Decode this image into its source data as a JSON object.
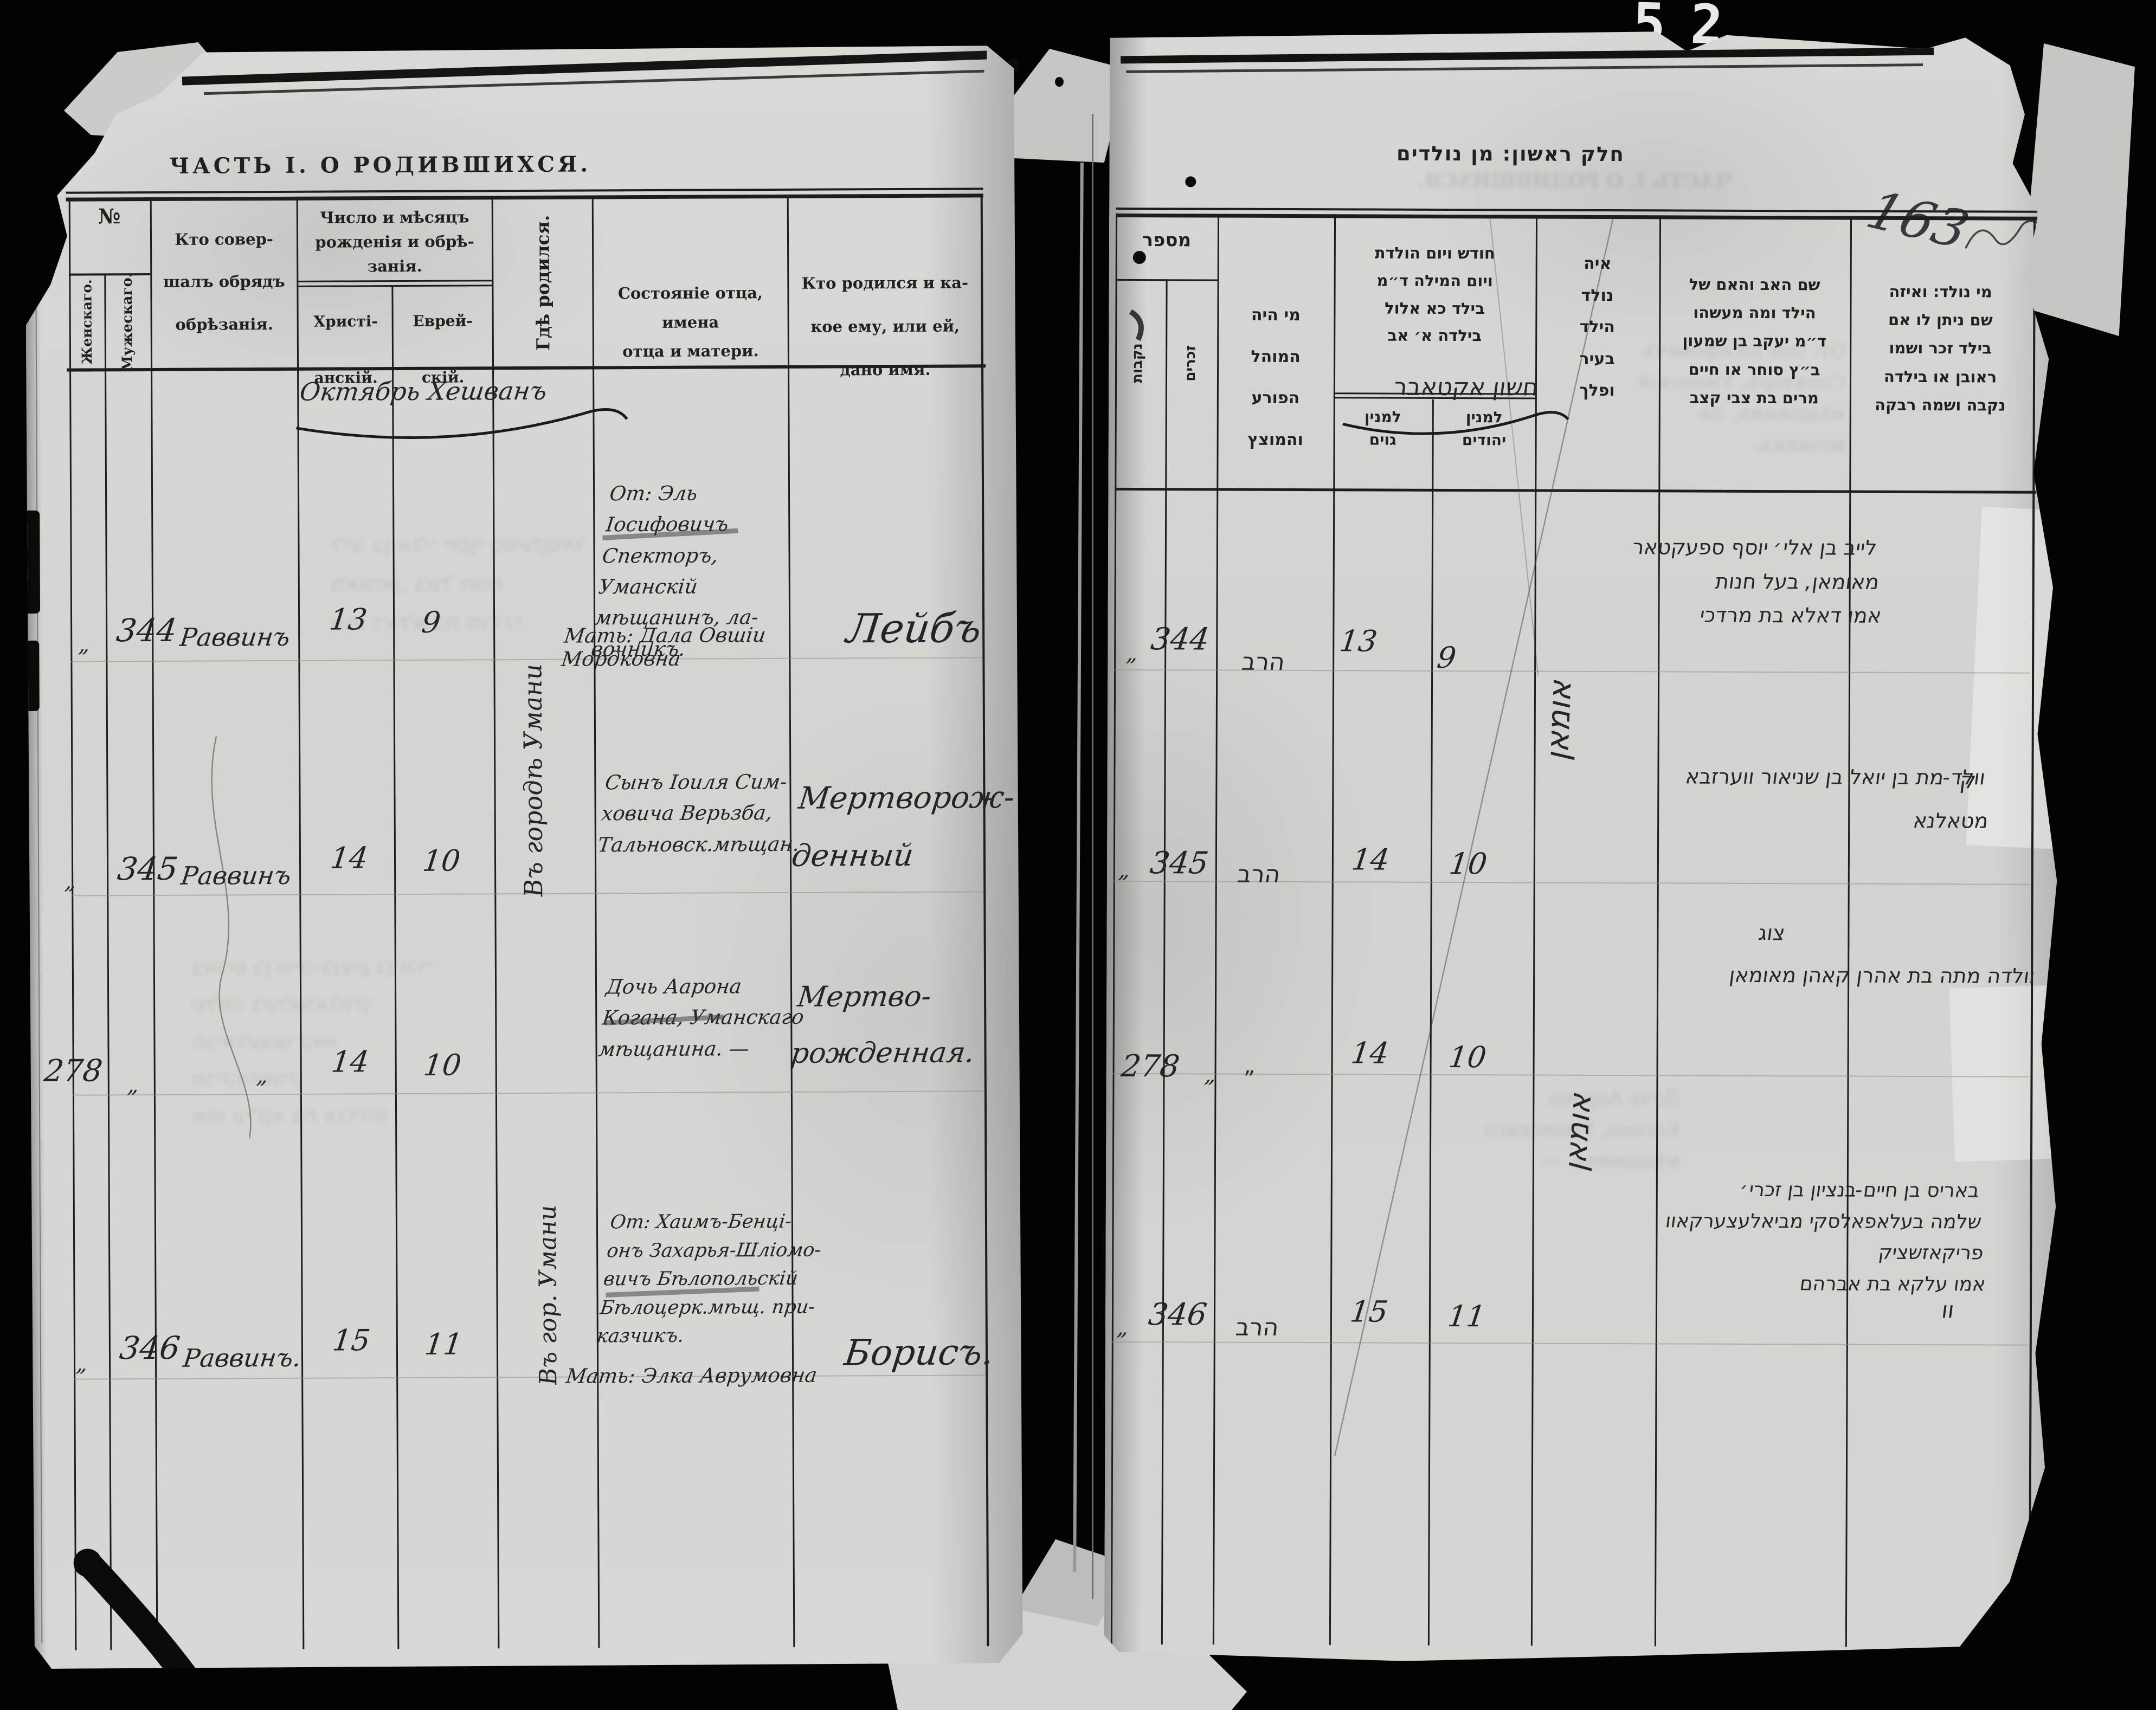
{
  "sheet": {
    "corner_number": "52",
    "folio_number": "163"
  },
  "left_page": {
    "title": "ЧАСТЬ I.  О  РОДИВШИХСЯ.",
    "header": {
      "number": "№",
      "number_female": "Женскаго.",
      "number_male": "Мужескаго.",
      "officiant": "Кто совер-\nшалъ обрядъ\nобрѣзанія.",
      "dates_group": "Число и мѣсяцъ\nрожденія и обрѣ-\nзанія.",
      "date_christian": "Христі-\nанскій.",
      "date_jewish": "Еврей-\nскій.",
      "birthplace": "Гдѣ родился.",
      "parents": "Состояніе отца, имена\nотца и матери.",
      "who_born": "Кто родился и ка-\nкое ему, или ей,\nдано имя."
    },
    "month_note": "Октябрь Хешванъ",
    "birthplace_note_1": "Въ городѣ Умани",
    "birthplace_note_2": "Въ гор. Умани",
    "rows": [
      {
        "no_female": "„",
        "no_male": "344",
        "officiant": "Раввинъ",
        "date_christian": "13",
        "date_jewish": "9",
        "father": "От: Эль Іосифовичъ\nСпекторъ, Уманскій\nмѣщанинъ, ла-\nвочникъ.",
        "mother": "Мать: Дала Овшіи Мордковна",
        "name": "Лейбъ"
      },
      {
        "no_female": "„",
        "no_male": "345",
        "officiant": "Раввинъ",
        "date_christian": "14",
        "date_jewish": "10",
        "father": "Сынъ Іоиля Сим-\nховича Верьзба,\nТальновск.мѣщан.",
        "mother": "",
        "name": "Мертворож-\nденный"
      },
      {
        "no_female": "278",
        "no_male": "„",
        "officiant": "„",
        "date_christian": "14",
        "date_jewish": "10",
        "father": "Дочь Аарона\nКогана, Уманскаго\nмѣщанина. —",
        "mother": "",
        "name": "Мертво-\nрожденная."
      },
      {
        "no_female": "„",
        "no_male": "346",
        "officiant": "Раввинъ.",
        "date_christian": "15",
        "date_jewish": "11",
        "father": "От: Хаимъ-Бенці-\nонъ Захарья-Шліомо-\nвичъ Бѣлопольскій\nБѣлоцерк.мѣщ. при-\nказчикъ.",
        "mother": "Мать: Элка Аврумовна",
        "name": "Борисъ."
      }
    ]
  },
  "right_page": {
    "title": "חלק ראשון: מן נולדים",
    "header": {
      "number": "מספר",
      "number_female": "נקבות",
      "number_male": "זכרים",
      "mohel": "מי היה\nהמוהל\nהפורע\nוהמוצץ",
      "dates_group": "חודש ויום הולדת\nויום המילה ד״מ\nבילד כא אלול\nבילדה א׳ אב",
      "date_christian": "למנין\nגוים",
      "date_jewish": "למנין\nיהודים",
      "birthplace": "איה\nנולד\nהילד\nבעיר\nופלך",
      "parents": "שם האב והאם של\nהילד ומה מעשהו\nד״מ יעקב בן שמעון\nב״ץ סוחר או חיים\nמרים בת צבי קצב",
      "who_born": "מי נולד: ואיזה\nשם ניתן לו אם\nבילד זכר ושמו\nראובן או בילדה\nנקבה ושמה רבקה"
    },
    "month_note": "חשון אקטאבר",
    "birthplace_note": "אומאן",
    "rows": [
      {
        "no_female": "„",
        "no_male": "344",
        "mohel": "הרב",
        "date_christian": "13",
        "date_jewish": "9",
        "text": "לייב בן אלי׳ יוסף ספעקטאר\nמאומאן, בעל חנות\nאמו דאלא בת מרדכי",
        "ditto_mark": "ק"
      },
      {
        "no_female": "„",
        "no_male": "345",
        "mohel": "הרב",
        "date_christian": "14",
        "date_jewish": "10",
        "text": "וולד-מת בן יואל בן שניאור ווערזבא\nמטאלנא",
        "ditto_mark": "צוג"
      },
      {
        "no_female": "278",
        "no_male": "„",
        "mohel": "„",
        "date_christian": "14",
        "date_jewish": "10",
        "text": "וולדה מתה בת אהרן קאהן מאומאן",
        "ditto_mark": ""
      },
      {
        "no_female": "„",
        "no_male": "346",
        "mohel": "הרב",
        "date_christian": "15",
        "date_jewish": "11",
        "text": "באריס בן חיים-בנציון בן זכרי׳\nשלמה בעלאפאלסקי מביאלעצערקאוו\nפריקאזשציק\nאמו עלקא בת אברהם",
        "ditto_mark": "וו"
      }
    ]
  }
}
